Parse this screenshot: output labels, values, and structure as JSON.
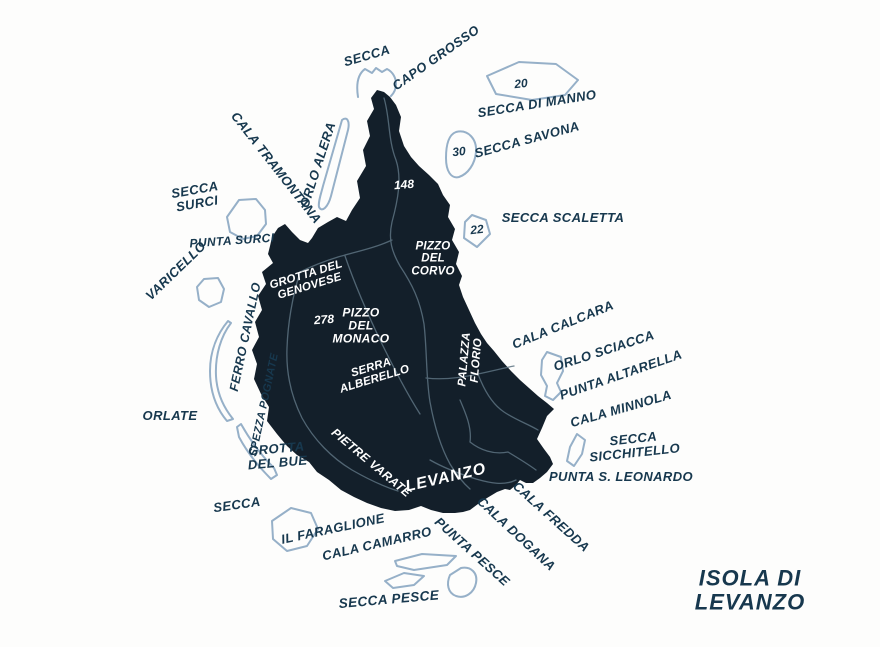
{
  "map": {
    "title": "ISOLA DI LEVANZO",
    "colors": {
      "background": "#fdfdfc",
      "island_fill": "#131f2a",
      "trail_line": "#5c7280",
      "shoal_outline": "#96b0c8",
      "label_dark": "#17384e",
      "label_white": "#ffffff"
    },
    "labels": {
      "secca_north": {
        "text": "SECCA"
      },
      "capo_grosso": {
        "text": "CAPO GROSSO"
      },
      "secca_di_manno": {
        "text": "SECCA DI MANNO"
      },
      "secca_savona": {
        "text": "SECCA SAVONA"
      },
      "secca_scaletta": {
        "text": "SECCA SCALETTA"
      },
      "cala_tramontana": {
        "text": "CALA TRAMONTANA"
      },
      "orlo_alera": {
        "text": "ORLO ALERA"
      },
      "secca_surci": {
        "text": "SECCA\nSURCI"
      },
      "punta_surci": {
        "text": "PUNTA SURCI"
      },
      "varicello": {
        "text": "VARICELLO"
      },
      "grotta_genovese": {
        "text": "GROTTA DEL\nGENOVESE"
      },
      "pizzo_corvo": {
        "text": "PIZZO\nDEL\nCORVO"
      },
      "pizzo_monaco": {
        "text": "PIZZO\nDEL\nMONACO"
      },
      "ferro_cavallo": {
        "text": "FERRO CAVALLO"
      },
      "serra_alberello": {
        "text": "SERRA\nALBERELLO"
      },
      "palazza_florio": {
        "text": "PALAZZA\nFLORIO"
      },
      "cala_calcara": {
        "text": "CALA CALCARA"
      },
      "orlo_sciacca": {
        "text": "ORLO SCIACCA"
      },
      "punta_altarella": {
        "text": "PUNTA ALTARELLA"
      },
      "spezza_pognate": {
        "text": "SPEZZA POGNATE"
      },
      "orlate": {
        "text": "ORLATE"
      },
      "cala_minnola": {
        "text": "CALA MINNOLA"
      },
      "secca_sicchitello": {
        "text": "SECCA\nSICCHITELLO"
      },
      "grotta_bue": {
        "text": "GROTTA\nDEL BUE"
      },
      "pietre_varate": {
        "text": "PIETRE VARATE"
      },
      "levanzo": {
        "text": "LEVANZO"
      },
      "punta_leonardo": {
        "text": "PUNTA S. LEONARDO"
      },
      "cala_fredda": {
        "text": "CALA FREDDA"
      },
      "secca_sw": {
        "text": "SECCA"
      },
      "il_faraglione": {
        "text": "IL FARAGLIONE"
      },
      "cala_camarro": {
        "text": "CALA CAMARRO"
      },
      "cala_dogana": {
        "text": "CALA DOGANA"
      },
      "punta_pesce": {
        "text": "PUNTA PESCE"
      },
      "secca_pesce": {
        "text": "SECCA PESCE"
      }
    },
    "depth_markers": {
      "manno": {
        "text": "20"
      },
      "savona": {
        "text": "30"
      },
      "scaletta": {
        "text": "22"
      }
    },
    "elevation_markers": {
      "north_peak": {
        "text": "148"
      },
      "monaco_peak": {
        "text": "278"
      }
    }
  }
}
